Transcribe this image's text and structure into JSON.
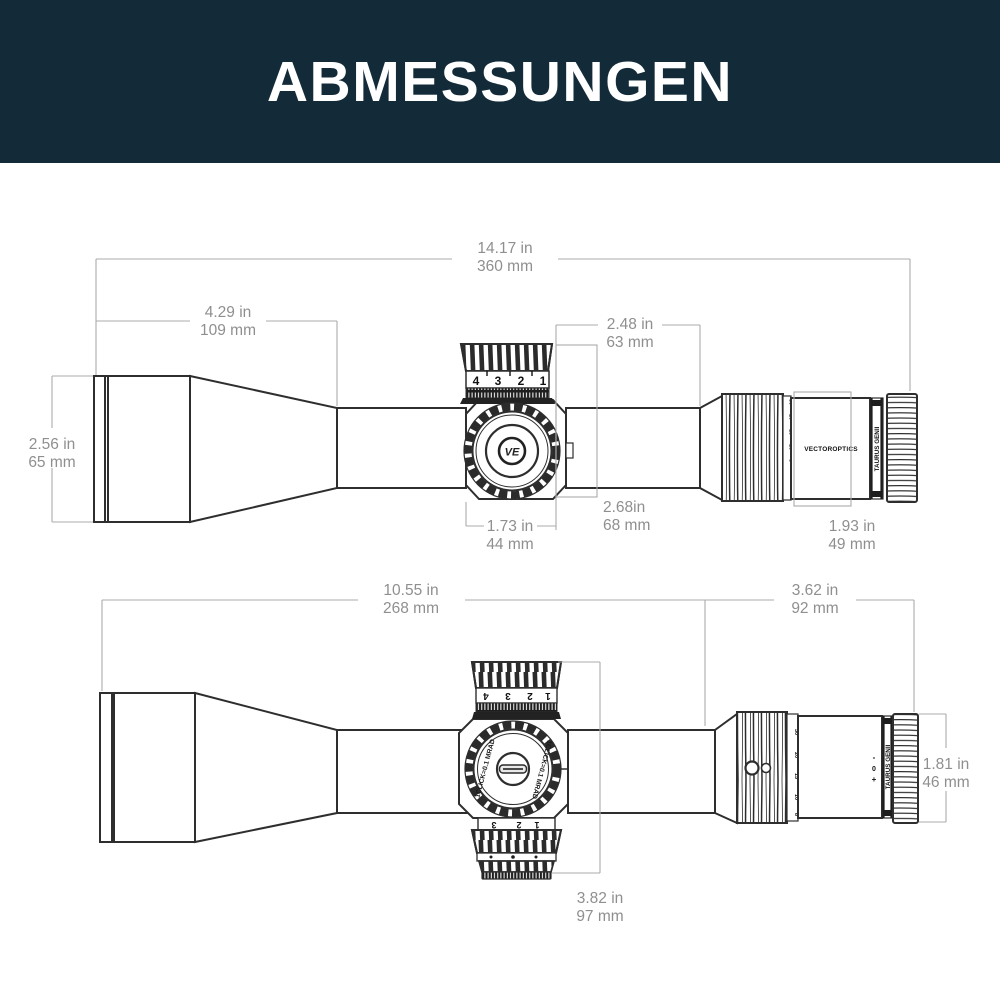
{
  "header": {
    "title": "ABMESSUNGEN",
    "background": "#132b39",
    "text_color": "#ffffff"
  },
  "colors": {
    "outline": "#2e2e2e",
    "dimension_line": "#ababab",
    "dimension_text": "#8f8f8f",
    "background": "#ffffff"
  },
  "top_view": {
    "dims": {
      "overall": {
        "in": "14.17 in",
        "mm": "360 mm"
      },
      "objective_length": {
        "in": "4.29 in",
        "mm": "109 mm"
      },
      "objective_diameter": {
        "in": "2.56 in",
        "mm": "65 mm"
      },
      "saddle_to_eyepiece": {
        "in": "2.48 in",
        "mm": "63 mm"
      },
      "height_at_turret": {
        "in": "2.68in",
        "mm": "68 mm"
      },
      "saddle_width": {
        "in": "1.73 in",
        "mm": "44 mm"
      },
      "eyepiece_length": {
        "in": "1.93 in",
        "mm": "49 mm"
      }
    },
    "turret_numbers": [
      "4",
      "3",
      "2",
      "1"
    ],
    "mag_numbers": [
      "8",
      "10",
      "15",
      "20",
      "30"
    ],
    "brand_label": "VECTOROPTICS",
    "model_label": "TAURUS GENII",
    "logo_text": "VE"
  },
  "bottom_view": {
    "dims": {
      "body_length": {
        "in": "10.55 in",
        "mm": "268 mm"
      },
      "eyepiece_assembly": {
        "in": "3.62 in",
        "mm": "92 mm"
      },
      "eyepiece_diameter": {
        "in": "1.81 in",
        "mm": "46 mm"
      },
      "turret_span": {
        "in": "3.82 in",
        "mm": "97 mm"
      }
    },
    "dial_label_left": "1CLICK=0.1 MRAD",
    "dial_label_right": "1CLICK=0.1 MRAD",
    "top_knob_numbers": [
      "4",
      "3",
      "2",
      "1"
    ],
    "lower_knob_numbers": [
      "3",
      "2",
      "1"
    ],
    "mag_numbers": [
      "8",
      "10",
      "15",
      "20",
      "30"
    ],
    "model_label": "TAURUS GENII",
    "diopter_marks": [
      "-",
      "0",
      "+"
    ]
  }
}
